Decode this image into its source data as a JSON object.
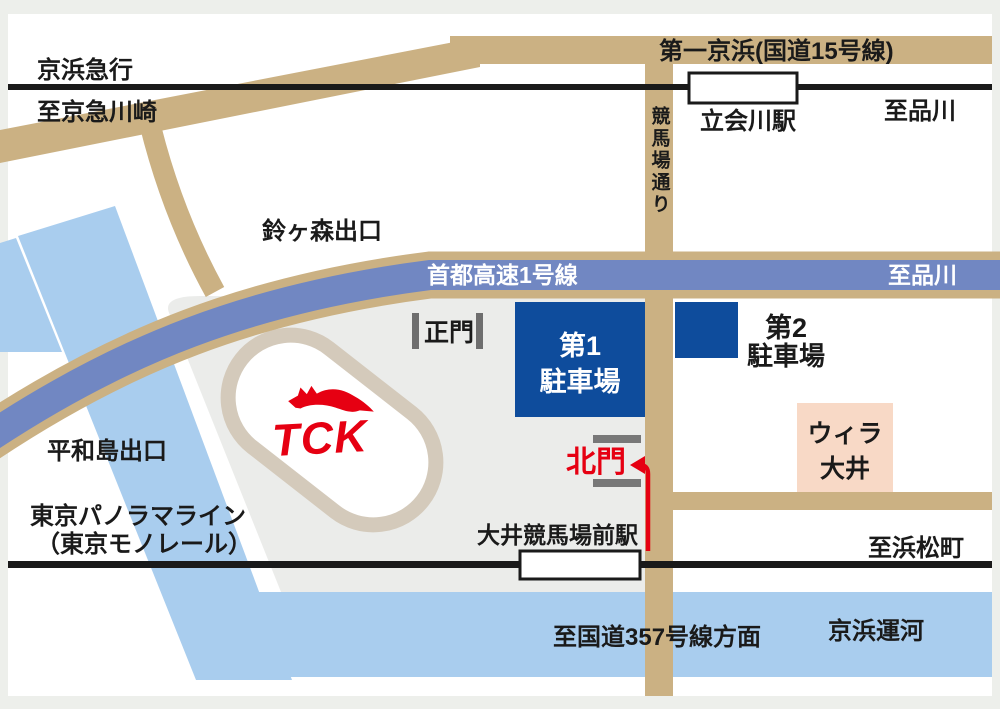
{
  "map": {
    "title": "大井競馬場(TCK)周辺アクセスマップ",
    "colors": {
      "road": "#cbb183",
      "expressway": "#7187c2",
      "canal": "#a9cdee",
      "parking_blue": "#0e4c9c",
      "willa_pink": "#f8d9c6",
      "grounds_gray": "#ebecea",
      "track_ring": "#d4cabb",
      "route_red": "#e60012",
      "line_black": "#1a1a1a",
      "gate_gray": "#6e6e6e",
      "frame_gray": "#edefeb",
      "white": "#ffffff"
    },
    "labels": {
      "keihin_kyuko": "京浜急行",
      "to_keikyu_kawasaki": "至京急川崎",
      "daiichi_keihin": "第一京浜(国道15号線)",
      "tachiaigawa_station": "立会川駅",
      "to_shinagawa_top": "至品川",
      "keibajo_dori": "競馬場通り",
      "suzugamori_exit": "鈴ヶ森出口",
      "shuto_expressway": "首都高速1号線",
      "to_shinagawa_expwy": "至品川",
      "main_gate": "正門",
      "parking1_line1": "第1",
      "parking1_line2": "駐車場",
      "parking2_line1": "第2",
      "parking2_line2": "駐車場",
      "willa_line1": "ウィラ",
      "willa_line2": "大井",
      "heiwajima_exit": "平和島出口",
      "north_gate": "北門",
      "tck_logo": "TCK",
      "monorail_line1": "東京パノラマライン",
      "monorail_line2": "（東京モノレール）",
      "oikeibajo_station": "大井競馬場前駅",
      "to_hamamatsucho": "至浜松町",
      "to_route357": "至国道357号線方面",
      "keihin_canal": "京浜運河"
    }
  }
}
